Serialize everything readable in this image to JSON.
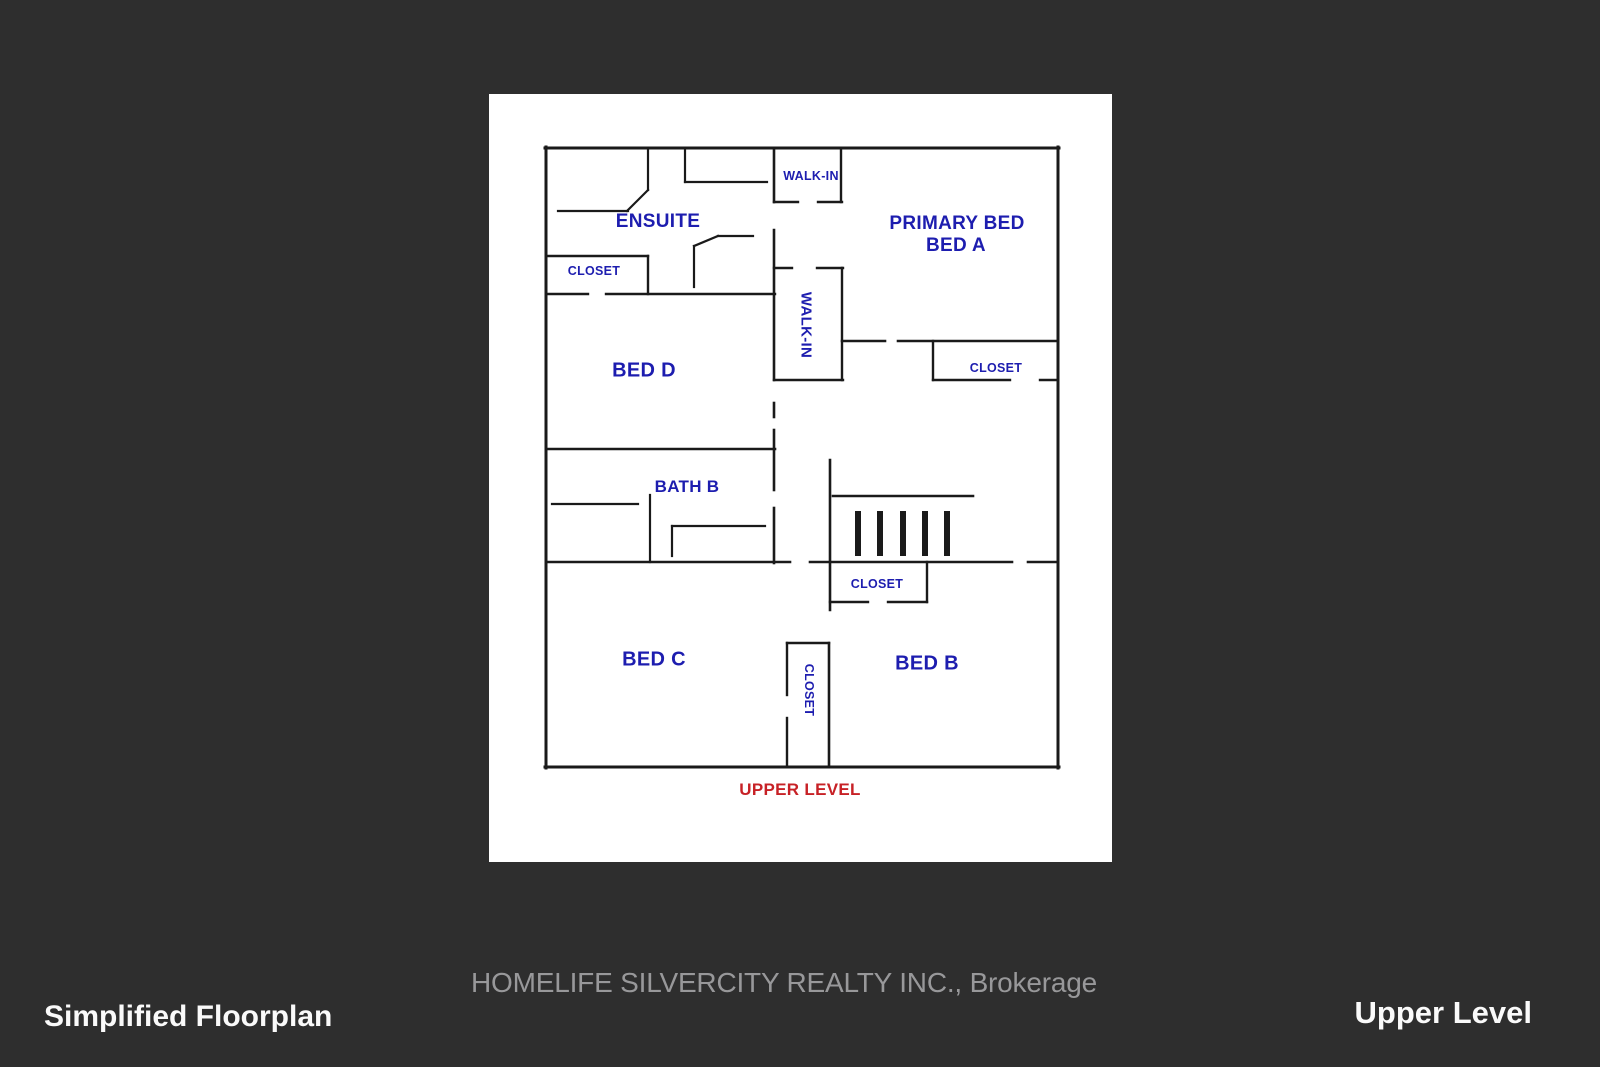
{
  "page": {
    "background": "#2e2e2e"
  },
  "card": {
    "background": "#ffffff",
    "x": 489,
    "y": 94,
    "w": 623,
    "h": 768
  },
  "footer": {
    "brokerage": "HOMELIFE SILVERCITY REALTY INC., Brokerage",
    "left_title": "Simplified Floorplan",
    "right_title": "Upper Level"
  },
  "floorplan": {
    "wall_color": "#1a1a1a",
    "label_color": "#1d1daf",
    "level_label": {
      "name": "upper-level-label",
      "text": "UPPER LEVEL",
      "x": 800,
      "y": 790,
      "size": 17,
      "color": "#c72126"
    },
    "labels": [
      {
        "name": "room-label-ensuite",
        "text": "ENSUITE",
        "x": 658,
        "y": 222,
        "size": 19,
        "rotate": 0
      },
      {
        "name": "room-label-walkin-top",
        "text": "WALK-IN",
        "x": 811,
        "y": 176,
        "size": 12.5,
        "rotate": 0
      },
      {
        "name": "room-label-primary-bed",
        "text": "PRIMARY BED",
        "x": 957,
        "y": 224,
        "size": 19,
        "rotate": 0
      },
      {
        "name": "room-label-bed-a",
        "text": "BED A",
        "x": 956,
        "y": 246,
        "size": 19,
        "rotate": 0
      },
      {
        "name": "room-label-closet-ensuite",
        "text": "CLOSET",
        "x": 594,
        "y": 271,
        "size": 12.5,
        "rotate": 0
      },
      {
        "name": "room-label-walkin-center",
        "text": "WALK-IN",
        "x": 806,
        "y": 325,
        "size": 15,
        "rotate": 90
      },
      {
        "name": "room-label-closet-bed-a",
        "text": "CLOSET",
        "x": 996,
        "y": 368,
        "size": 12.5,
        "rotate": 0
      },
      {
        "name": "room-label-bed-d",
        "text": "BED D",
        "x": 644,
        "y": 371,
        "size": 20,
        "rotate": 0
      },
      {
        "name": "room-label-bath-b",
        "text": "BATH B",
        "x": 687,
        "y": 487,
        "size": 17,
        "rotate": 0
      },
      {
        "name": "room-label-closet-bed-b",
        "text": "CLOSET",
        "x": 877,
        "y": 584,
        "size": 12.5,
        "rotate": 0
      },
      {
        "name": "room-label-bed-c",
        "text": "BED C",
        "x": 654,
        "y": 660,
        "size": 20,
        "rotate": 0
      },
      {
        "name": "room-label-bed-b",
        "text": "BED B",
        "x": 927,
        "y": 664,
        "size": 20,
        "rotate": 0
      },
      {
        "name": "room-label-closet-bed-c",
        "text": "CLOSET",
        "x": 809,
        "y": 690,
        "size": 12.5,
        "rotate": 90
      }
    ],
    "walls": [
      [
        545,
        148,
        1059,
        148,
        3
      ],
      [
        546,
        147,
        546,
        768,
        3
      ],
      [
        1058,
        147,
        1058,
        768,
        3
      ],
      [
        545,
        767,
        1059,
        767,
        3
      ],
      [
        648,
        148,
        648,
        190,
        2.2
      ],
      [
        648,
        190,
        627,
        211,
        2.2
      ],
      [
        558,
        211,
        628,
        211,
        2.2
      ],
      [
        685,
        148,
        685,
        182,
        2.2
      ],
      [
        685,
        182,
        767,
        182,
        2.2
      ],
      [
        718,
        236,
        753,
        236,
        2.2
      ],
      [
        718,
        236,
        694,
        246,
        2.2
      ],
      [
        694,
        246,
        694,
        287,
        2.2
      ],
      [
        546,
        256,
        648,
        256,
        2.4
      ],
      [
        648,
        256,
        648,
        294,
        2.4
      ],
      [
        546,
        294,
        588,
        294,
        2.4
      ],
      [
        606,
        294,
        775,
        294,
        2.4
      ],
      [
        774,
        148,
        774,
        202,
        2.6
      ],
      [
        774,
        230,
        774,
        380,
        2.6
      ],
      [
        774,
        403,
        774,
        417,
        2.6
      ],
      [
        774,
        430,
        774,
        490,
        2.6
      ],
      [
        774,
        508,
        774,
        563,
        2.6
      ],
      [
        841,
        148,
        841,
        202,
        2.4
      ],
      [
        774,
        202,
        798,
        202,
        2.4
      ],
      [
        818,
        202,
        842,
        202,
        2.4
      ],
      [
        774,
        268,
        792,
        268,
        2.4
      ],
      [
        817,
        268,
        843,
        268,
        2.4
      ],
      [
        842,
        268,
        842,
        380,
        2.4
      ],
      [
        774,
        380,
        843,
        380,
        2.4
      ],
      [
        842,
        341,
        885,
        341,
        2.6
      ],
      [
        898,
        341,
        1058,
        341,
        2.6
      ],
      [
        933,
        341,
        933,
        380,
        2.4
      ],
      [
        933,
        380,
        1010,
        380,
        2.4
      ],
      [
        1040,
        380,
        1058,
        380,
        2.4
      ],
      [
        546,
        449,
        775,
        449,
        2.6
      ],
      [
        552,
        504,
        638,
        504,
        2.2
      ],
      [
        650,
        495,
        650,
        562,
        2.2
      ],
      [
        672,
        526,
        765,
        526,
        2.2
      ],
      [
        672,
        526,
        672,
        556,
        2.2
      ],
      [
        546,
        562,
        790,
        562,
        2.6
      ],
      [
        810,
        562,
        1012,
        562,
        2.6
      ],
      [
        1028,
        562,
        1058,
        562,
        2.6
      ],
      [
        830,
        460,
        830,
        610,
        2.6
      ],
      [
        833,
        496,
        973,
        496,
        2.6
      ],
      [
        830,
        602,
        868,
        602,
        2.4
      ],
      [
        888,
        602,
        927,
        602,
        2.4
      ],
      [
        927,
        562,
        927,
        602,
        2.4
      ],
      [
        829,
        643,
        829,
        767,
        2.6
      ],
      [
        787,
        643,
        829,
        643,
        2.4
      ],
      [
        787,
        643,
        787,
        695,
        2.4
      ],
      [
        787,
        718,
        787,
        767,
        2.4
      ]
    ],
    "stairs": {
      "tread_xs": [
        858,
        880,
        903,
        925,
        947
      ],
      "y1": 514,
      "y2": 553,
      "width": 6
    }
  }
}
